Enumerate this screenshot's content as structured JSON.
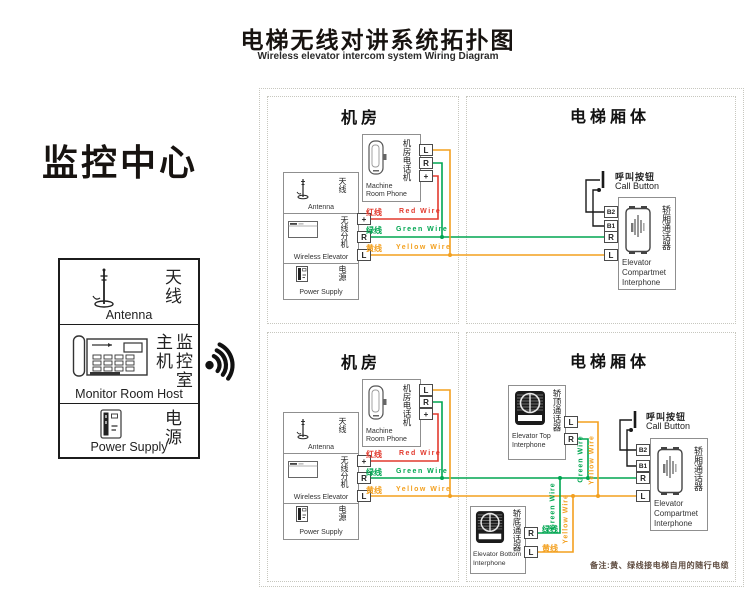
{
  "title": {
    "zh": "电梯无线对讲系统拓扑图",
    "en": "Wireless elevator intercom system Wiring Diagram"
  },
  "monitor_center": {
    "heading": "监控中心",
    "antenna": {
      "zh": "天线",
      "en": "Antenna"
    },
    "host": {
      "zh": "监控室主机",
      "en": "Monitor Room Host"
    },
    "power": {
      "zh": "电源",
      "en": "Power Supply"
    }
  },
  "section_labels": {
    "machine_room": "机房",
    "elevator_body": "电梯厢体"
  },
  "machine_room": {
    "phone": {
      "zh": "机房电话机",
      "en1": "Machine",
      "en2": "Room Phone",
      "terminals": [
        "L",
        "R",
        "+"
      ]
    },
    "unit": {
      "antenna": {
        "zh": "天线",
        "en": "Antenna"
      },
      "wireless": {
        "zh": "无线分机",
        "en": "Wireless Elevator"
      },
      "power": {
        "zh": "电源",
        "en": "Power Supply"
      },
      "terminals": [
        "+",
        "R",
        "L"
      ]
    },
    "wires": {
      "red": {
        "zh": "红线",
        "en": "Red Wire"
      },
      "green": {
        "zh": "绿线",
        "en": "Green Wire"
      },
      "yellow": {
        "zh": "黄线",
        "en": "Yellow Wire"
      }
    }
  },
  "elevator_body": {
    "call_button": {
      "zh": "呼叫按钮",
      "en": "Call Button"
    },
    "compartment_interphone": {
      "zh": "轿厢通话器",
      "en1": "Elevator",
      "en2": "Compartmet",
      "en3": "Interphone",
      "terminals": [
        "B2",
        "B1",
        "R",
        "L"
      ]
    },
    "top_interphone": {
      "zh": "轿顶通话器",
      "en1": "Elevator Top",
      "en2": "Interphone",
      "terminals": [
        "L",
        "R"
      ]
    },
    "bottom_interphone": {
      "zh": "轿底通话器",
      "en1": "Elevator Bottom",
      "en2": "Interphone",
      "terminals": [
        "R",
        "L"
      ],
      "green_label": "绿线",
      "yellow_label": "黄线"
    },
    "vertical_labels": {
      "green": "Green Wire",
      "yellow": "Yellow Wire"
    }
  },
  "note": "备注:黄、绿线接电梯自用的随行电缆",
  "wire_colors": {
    "red": "#e23a2e",
    "green": "#00a651",
    "yellow": "#f3a01f",
    "black": "#1a1a1a"
  }
}
